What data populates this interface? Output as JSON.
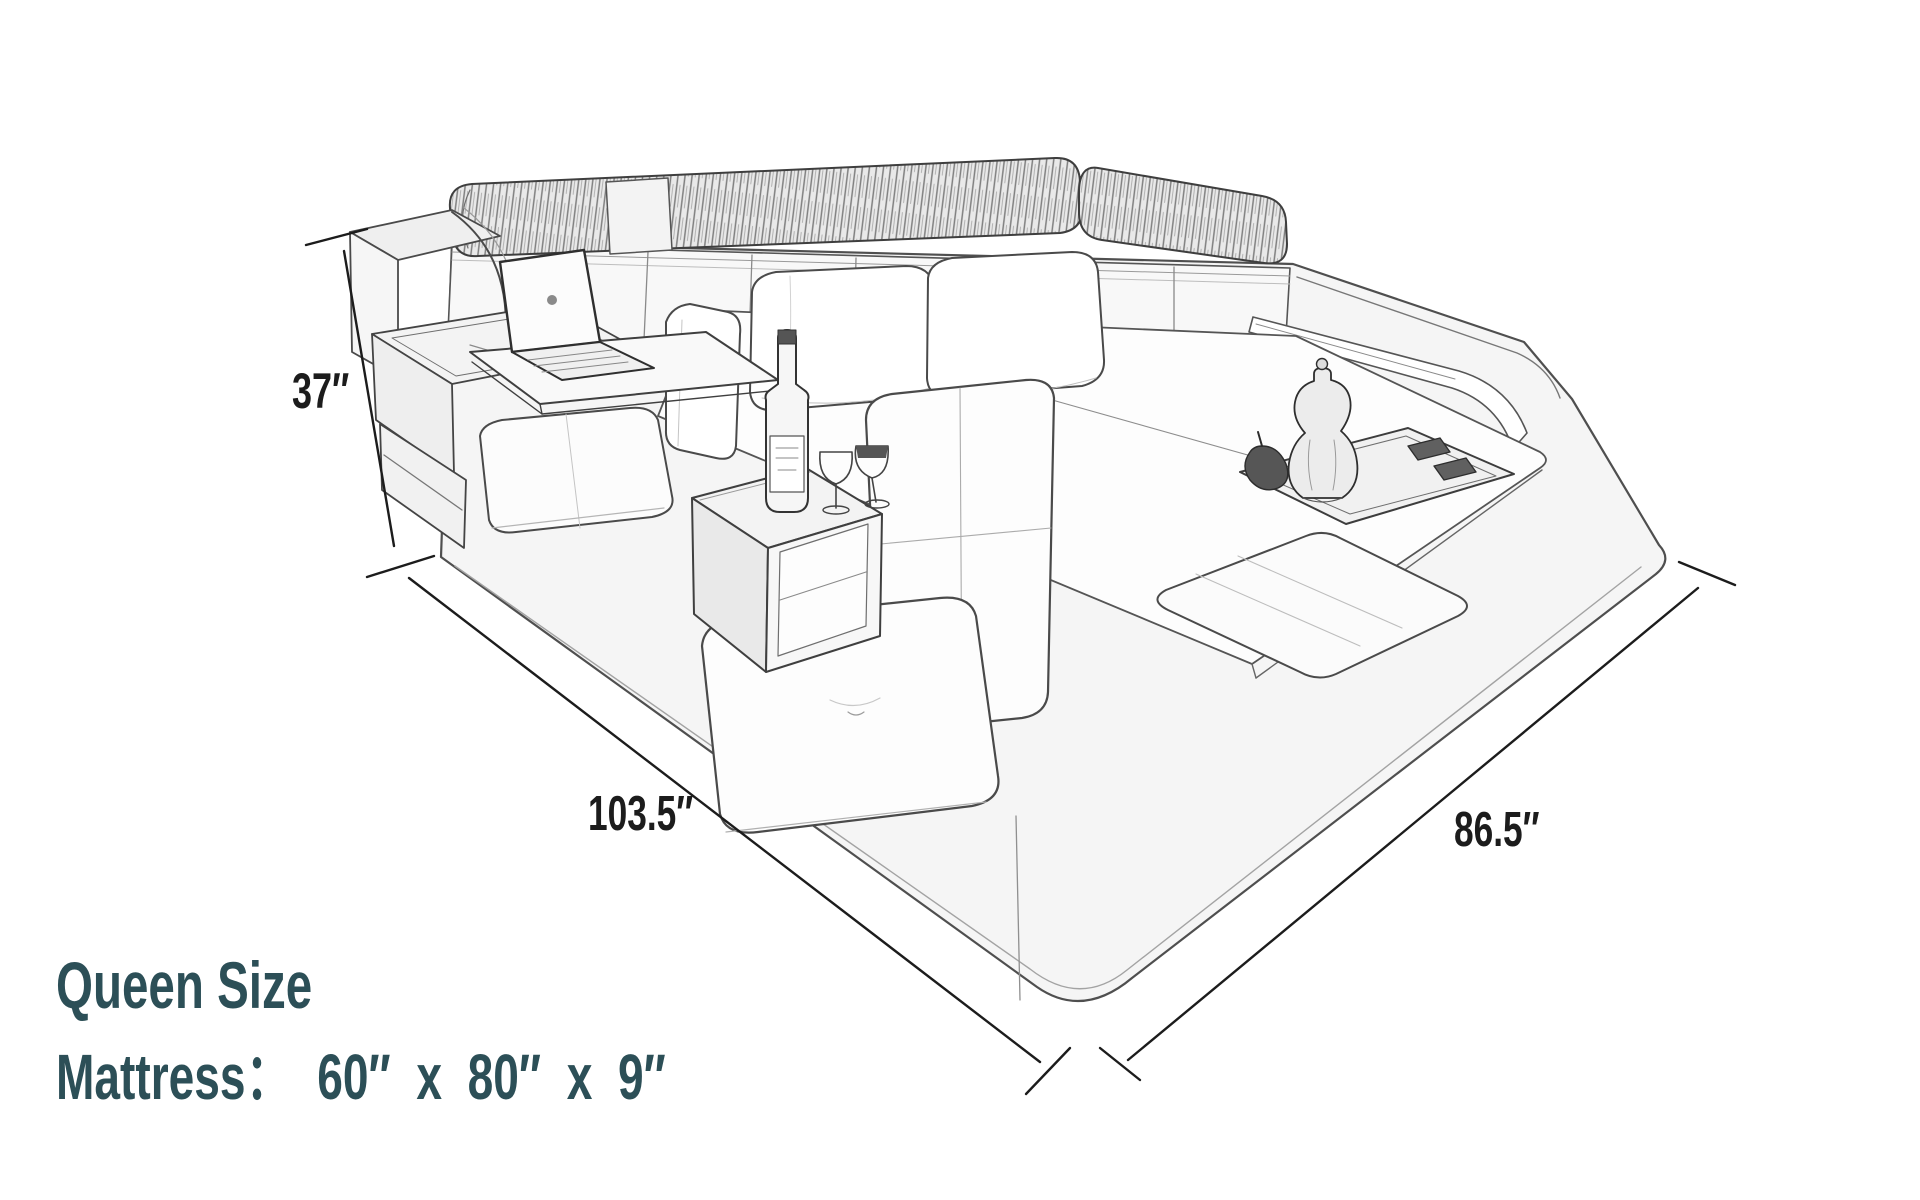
{
  "page": {
    "background": "#ffffff"
  },
  "illustration": {
    "name": "multifunctional-bed-pencil-sketch",
    "features": [
      "headboard-bolsters",
      "tufted-headboard",
      "storage-console",
      "laptop",
      "swivel-table",
      "pillows",
      "mattress",
      "serving-tray",
      "coffee-pot",
      "side-table",
      "wine-bottle",
      "wine-glasses",
      "lounge-chair",
      "ottoman-cushion",
      "led-side-rail"
    ]
  },
  "dimensions": {
    "height_label": "37″",
    "length_label": "103.5″",
    "width_label": "86.5″"
  },
  "caption": {
    "size_title": "Queen Size",
    "mattress_spec": "Mattress： 60″ x 80″ x 9″"
  },
  "colors": {
    "caption_text": "#2c4f57",
    "dimension_text": "#1c1c1c",
    "sketch_stroke": "#4a4a4a",
    "background": "#ffffff"
  }
}
